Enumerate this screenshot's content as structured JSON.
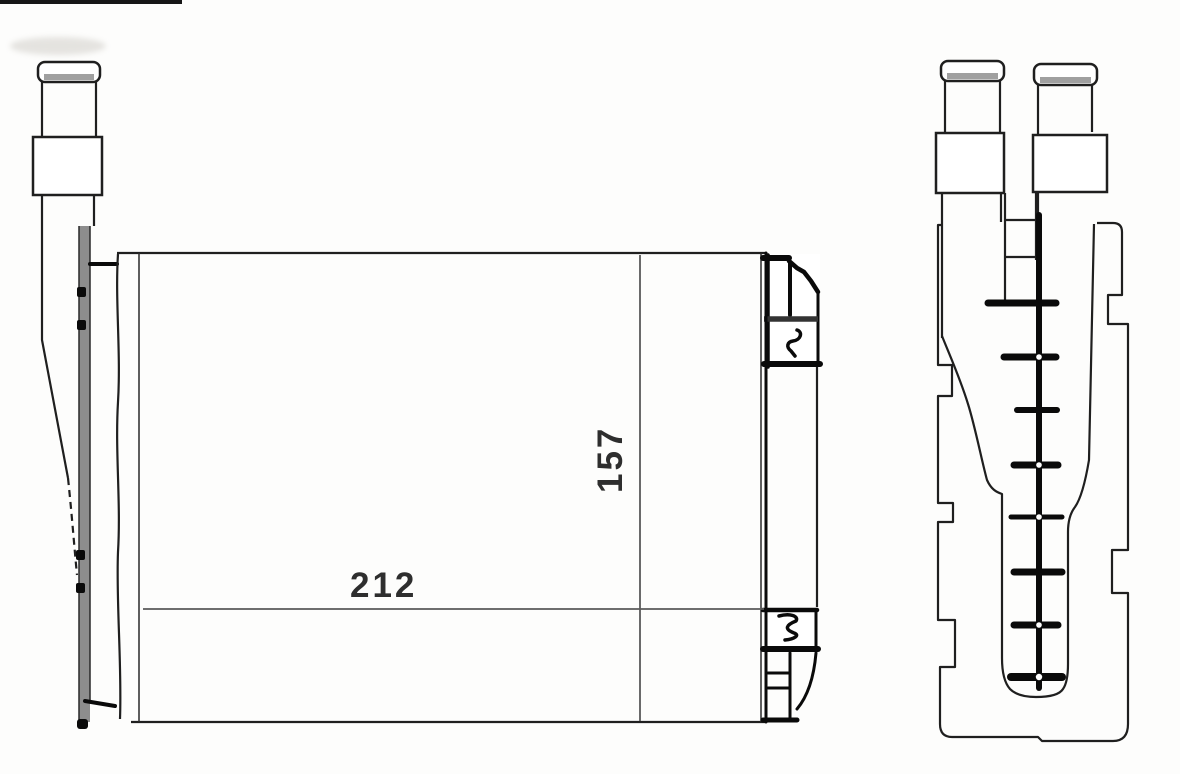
{
  "page": {
    "background": "#fdfdfc",
    "scan_artifact_bar_color": "#161616"
  },
  "drawing": {
    "dimensions": {
      "width_label": "212",
      "height_label": "157"
    },
    "colors": {
      "outline": "#1f1f1f",
      "heavy_black": "#0a0a0a",
      "pipe_gray": "#8d8d8d",
      "dimension_line": "#5a5a5a",
      "label_text": "#2e2e2e"
    }
  }
}
